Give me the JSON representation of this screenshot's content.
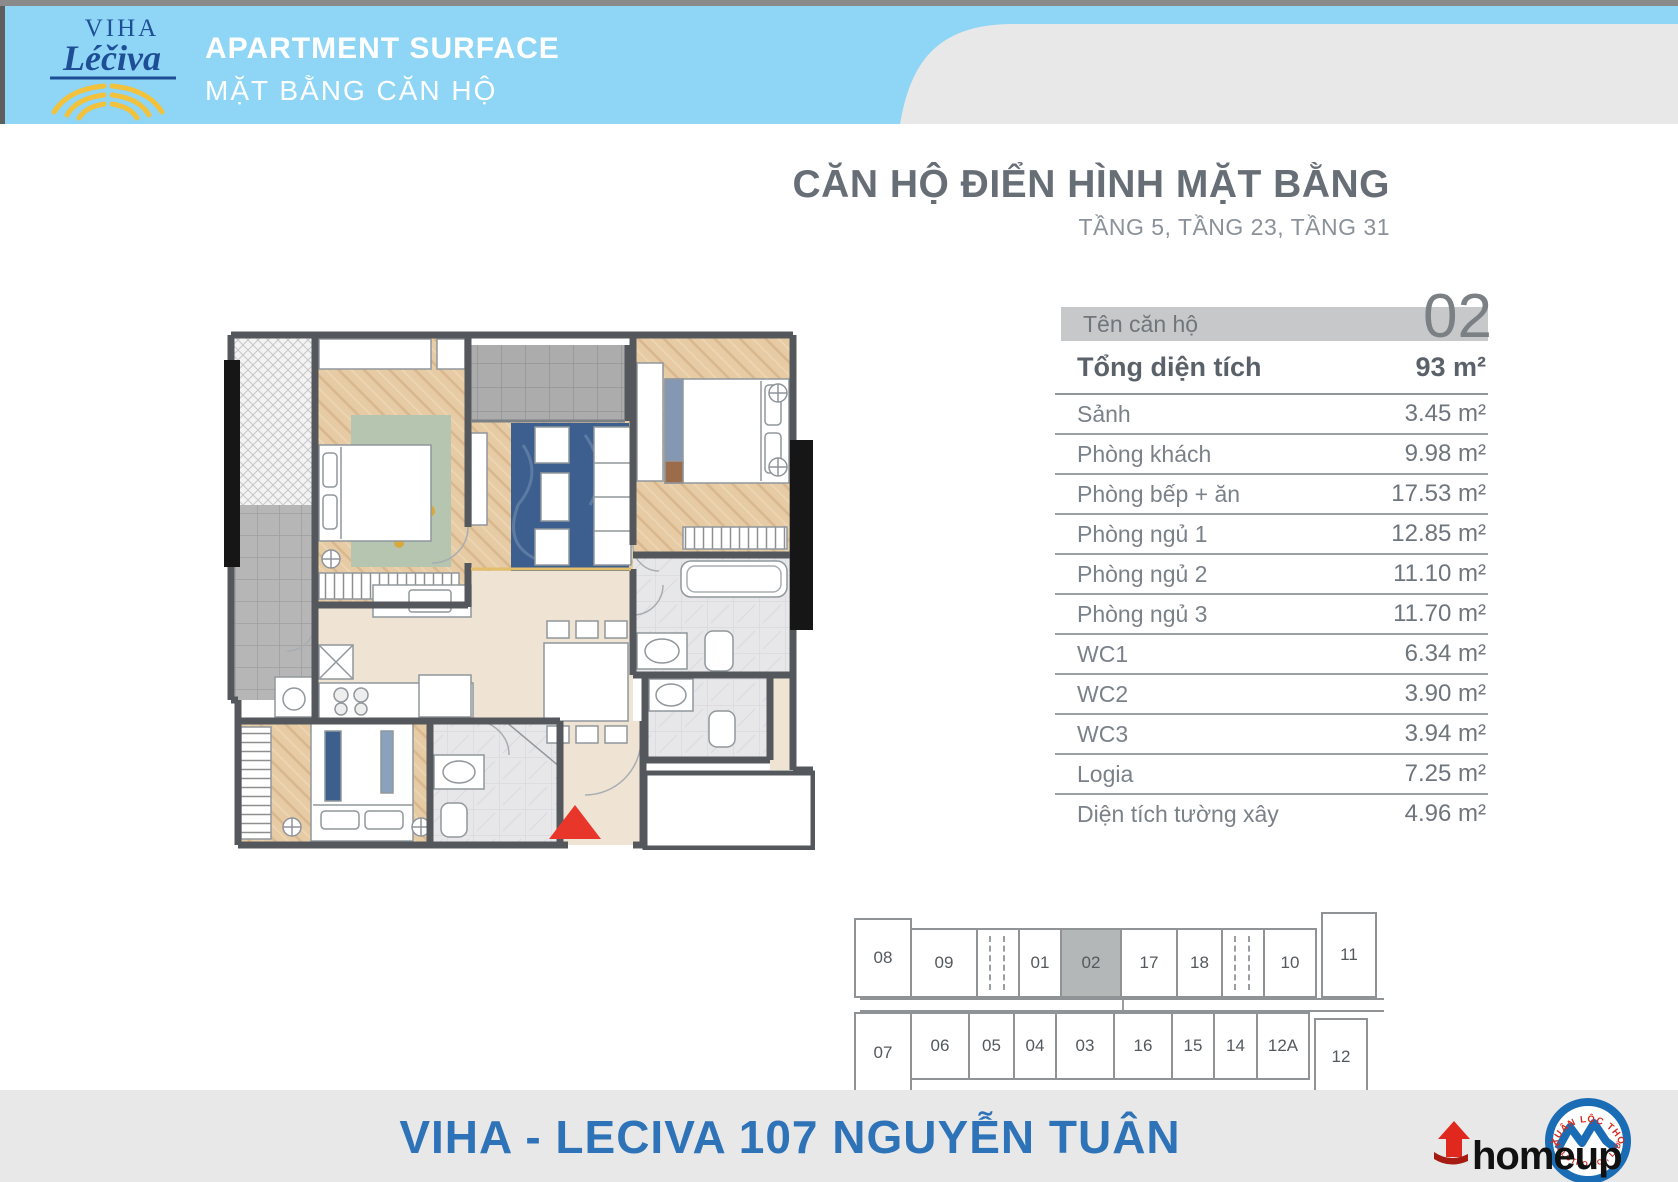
{
  "header": {
    "logo": {
      "line1": "VIHA",
      "line2": "Léčiva"
    },
    "title": "APARTMENT SURFACE",
    "subtitle": "MẶT BẰNG CĂN HỘ"
  },
  "main": {
    "title": "CĂN HỘ ĐIỂN HÌNH MẶT BẰNG",
    "subtitle": "TẦNG 5, TẦNG 23, TẦNG 31",
    "unit_label": "Tên căn hộ",
    "unit_number": "02",
    "total_row": {
      "label": "Tổng diện tích",
      "value": "93 m²"
    },
    "rows": [
      {
        "label": "Sảnh",
        "value": "3.45 m²"
      },
      {
        "label": "Phòng khách",
        "value": "9.98 m²"
      },
      {
        "label": "Phòng bếp + ăn",
        "value": "17.53 m²"
      },
      {
        "label": "Phòng ngủ 1",
        "value": "12.85 m²"
      },
      {
        "label": "Phòng ngủ 2",
        "value": "11.10 m²"
      },
      {
        "label": "Phòng ngủ 3",
        "value": "11.70 m²"
      },
      {
        "label": "WC1",
        "value": "6.34 m²"
      },
      {
        "label": "WC2",
        "value": "3.90 m²"
      },
      {
        "label": "WC3",
        "value": "3.94 m²"
      },
      {
        "label": "Logia",
        "value": "7.25 m²"
      },
      {
        "label": "Diện tích tường xây",
        "value": "4.96 m²"
      }
    ]
  },
  "floor_diagram": {
    "top_row": [
      {
        "label": "08",
        "tall": true
      },
      {
        "label": "09"
      },
      {
        "label": "",
        "shaft": true
      },
      {
        "label": "01"
      },
      {
        "label": "02",
        "highlight": true
      },
      {
        "label": "17"
      },
      {
        "label": "18"
      },
      {
        "label": "",
        "shaft": true
      },
      {
        "label": "10"
      },
      {
        "label": "11",
        "detached": true
      }
    ],
    "bottom_row": [
      {
        "label": "07",
        "tall": true
      },
      {
        "label": "06"
      },
      {
        "label": "05"
      },
      {
        "label": "04"
      },
      {
        "label": "03"
      },
      {
        "label": "16"
      },
      {
        "label": "15"
      },
      {
        "label": "14"
      },
      {
        "label": "12A"
      },
      {
        "label": "12",
        "detached": true
      }
    ]
  },
  "footer": {
    "project_name": "VIHA - LECIVA 107 NGUYỄN TUÂN",
    "brand": "homeup",
    "seal_top": "XUÂN LỘC THỌ",
    "seal_bottom": "XALOTHO CO., LTD"
  },
  "colors": {
    "header_blue": "#8ed5f6",
    "accent_blue": "#2e73b8",
    "brand_navy": "#1e4f96",
    "brand_yellow": "#f2c23c",
    "logo_red": "#e0281e",
    "seal_blue": "#1a6cb5",
    "table_bar_gray": "#c6c8c9",
    "highlight_cell_gray": "#b4b7b8",
    "footer_bg": "#e8e8e8"
  }
}
